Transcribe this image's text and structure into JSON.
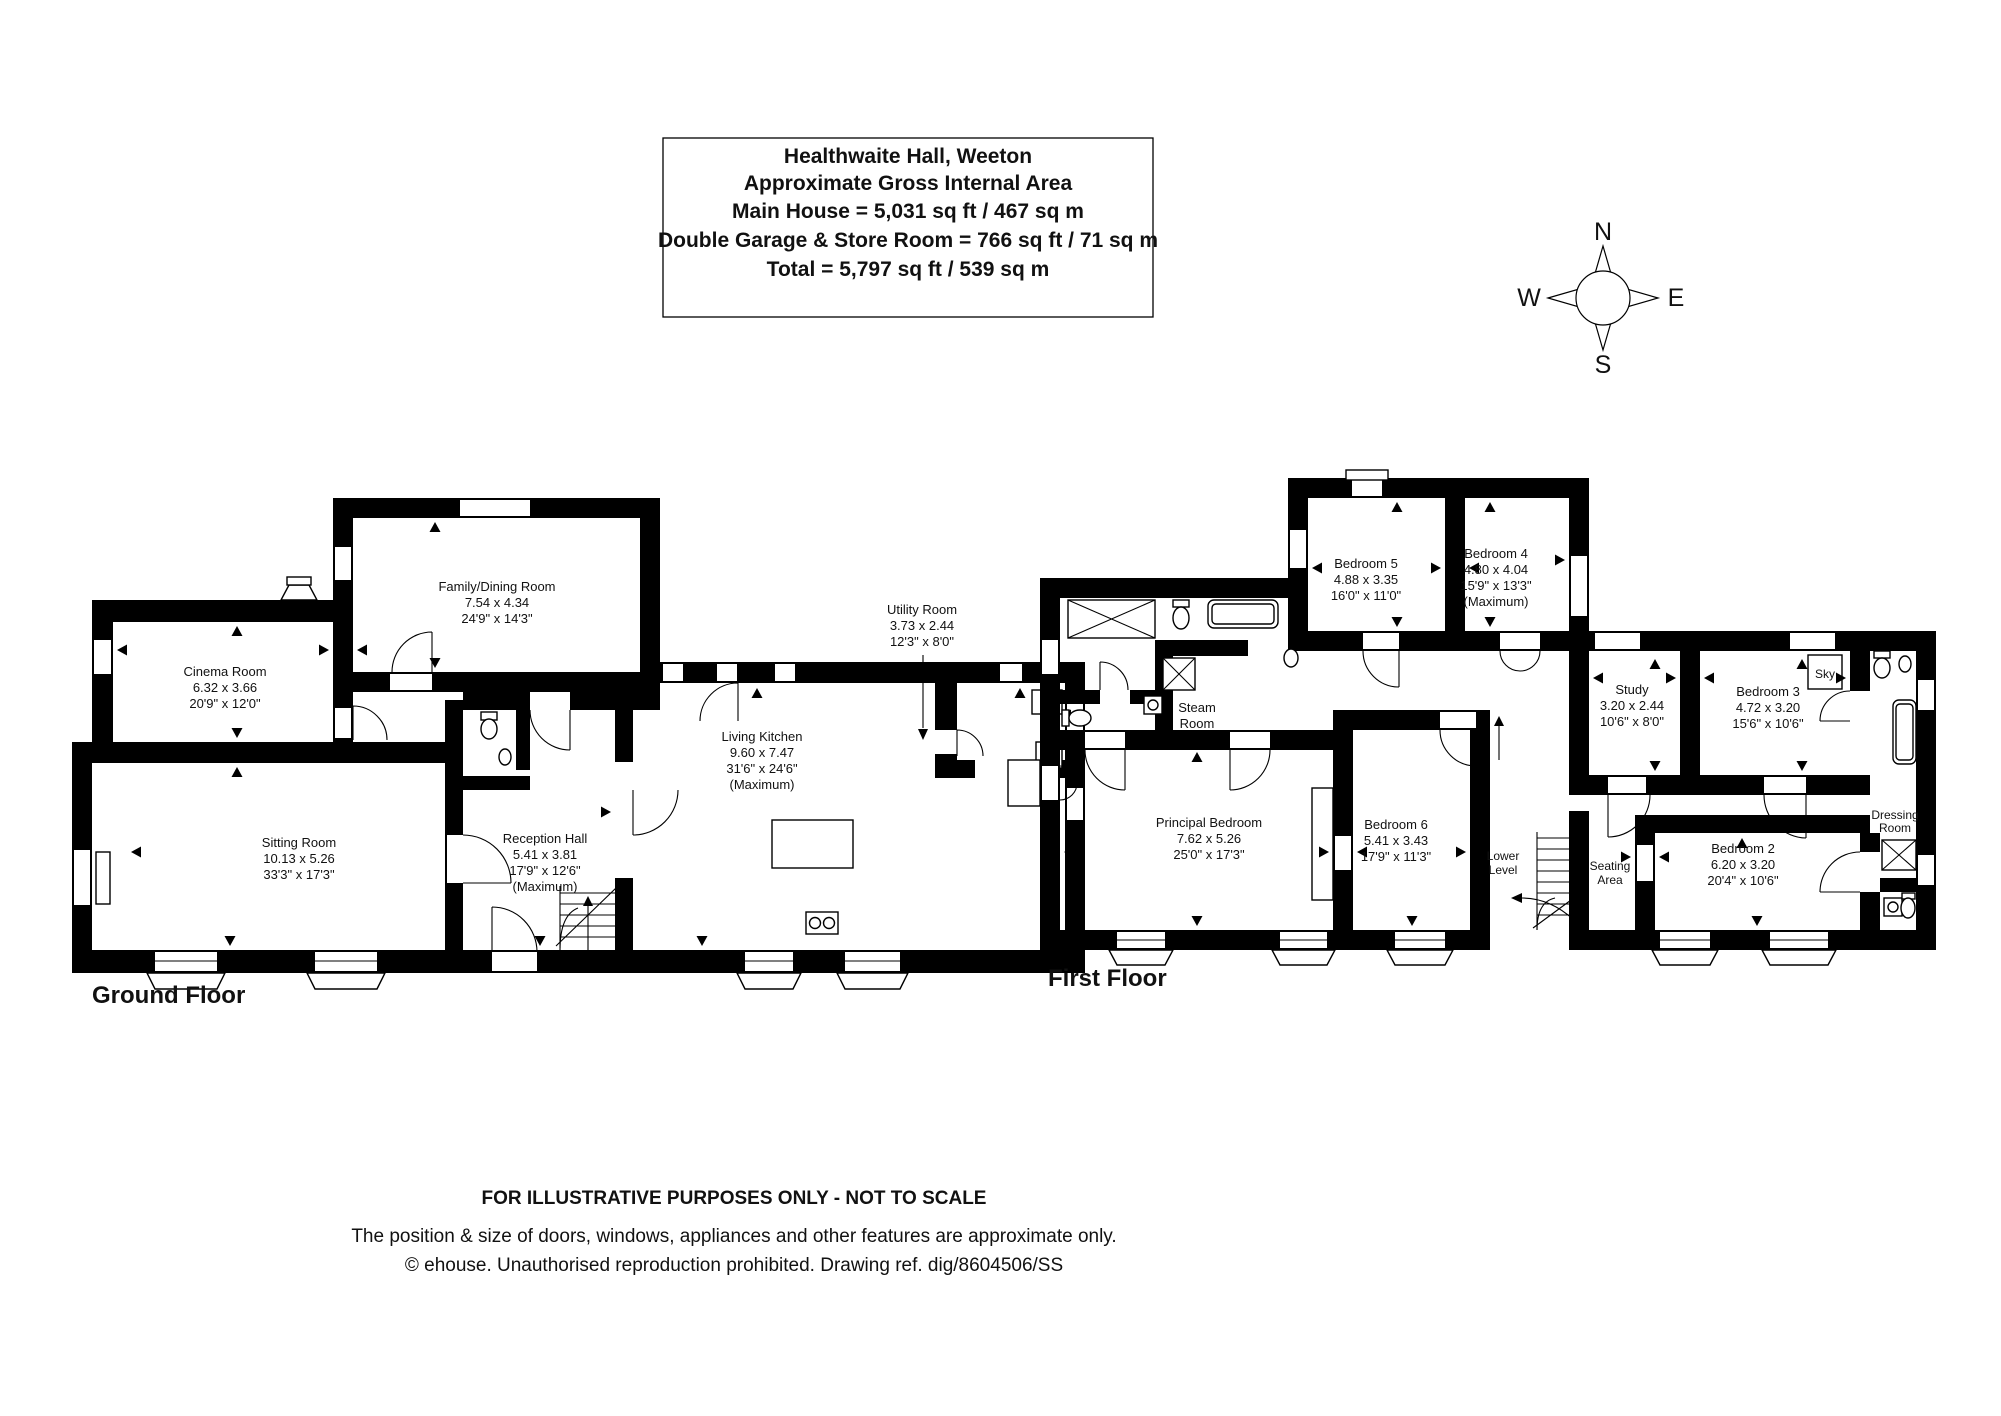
{
  "title": {
    "lines": [
      "Healthwaite Hall, Weeton",
      "Approximate Gross Internal Area",
      "Main House = 5,031 sq ft / 467 sq m",
      "Double Garage & Store Room = 766 sq ft / 71 sq m",
      "Total = 5,797 sq ft / 539 sq m"
    ]
  },
  "compass": {
    "n": "N",
    "e": "E",
    "s": "S",
    "w": "W"
  },
  "ground": {
    "label": "Ground Floor",
    "family": {
      "name": "Family/Dining Room",
      "metric": "7.54 x 4.34",
      "imperial": "24'9\" x 14'3\""
    },
    "cinema": {
      "name": "Cinema Room",
      "metric": "6.32 x 3.66",
      "imperial": "20'9\" x 12'0\""
    },
    "sitting": {
      "name": "Sitting Room",
      "metric": "10.13 x 5.26",
      "imperial": "33'3\" x 17'3\""
    },
    "reception": {
      "name": "Reception Hall",
      "metric": "5.41 x 3.81",
      "imperial": "17'9\" x 12'6\"",
      "note": "(Maximum)"
    },
    "kitchen": {
      "name": "Living Kitchen",
      "metric": "9.60 x 7.47",
      "imperial": "31'6\" x 24'6\"",
      "note": "(Maximum)"
    },
    "utility": {
      "name": "Utility Room",
      "metric": "3.73 x 2.44",
      "imperial": "12'3\" x 8'0\""
    }
  },
  "first": {
    "label": "First Floor",
    "bed5": {
      "name": "Bedroom 5",
      "metric": "4.88 x 3.35",
      "imperial": "16'0\" x 11'0\""
    },
    "bed4": {
      "name": "Bedroom 4",
      "metric": "4.80 x 4.04",
      "imperial": "15'9\" x 13'3\"",
      "note": "(Maximum)"
    },
    "study": {
      "name": "Study",
      "metric": "3.20 x 2.44",
      "imperial": "10'6\" x 8'0\""
    },
    "bed3": {
      "name": "Bedroom 3",
      "metric": "4.72 x 3.20",
      "imperial": "15'6\" x 10'6\""
    },
    "bed2": {
      "name": "Bedroom 2",
      "metric": "6.20 x 3.20",
      "imperial": "20'4\" x 10'6\""
    },
    "principal": {
      "name": "Principal Bedroom",
      "metric": "7.62 x 5.26",
      "imperial": "25'0\" x 17'3\""
    },
    "bed6": {
      "name": "Bedroom 6",
      "metric": "5.41 x 3.43",
      "imperial": "17'9\" x 11'3\""
    },
    "steam": {
      "line1": "Steam",
      "line2": "Room"
    },
    "lower": {
      "line1": "Lower",
      "line2": "Level"
    },
    "seating": {
      "line1": "Seating",
      "line2": "Area"
    },
    "dressing": {
      "line1": "Dressing",
      "line2": "Room"
    },
    "sky": "Sky"
  },
  "footer": {
    "lines": [
      "FOR ILLUSTRATIVE PURPOSES ONLY - NOT TO SCALE",
      "The position & size of doors, windows, appliances and other features are approximate only.",
      "© ehouse. Unauthorised reproduction prohibited. Drawing ref. dig/8604506/SS"
    ]
  }
}
